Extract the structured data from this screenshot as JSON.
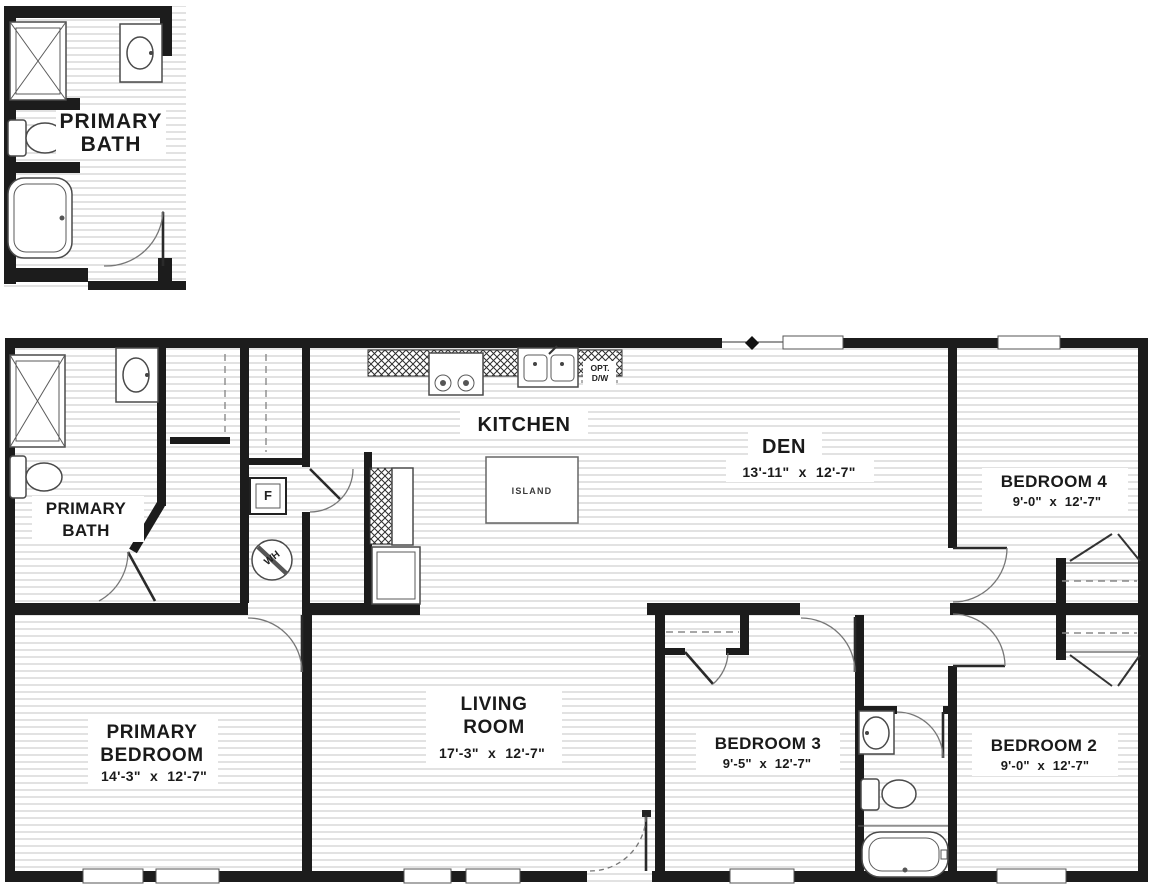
{
  "inset": {
    "title_line1": "PRIMARY",
    "title_line2": "BATH"
  },
  "rooms": {
    "primary_bath": {
      "line1": "PRIMARY",
      "line2": "BATH"
    },
    "kitchen": {
      "name": "KITCHEN"
    },
    "den": {
      "name": "DEN",
      "dims": "13'-11\" x 12'-7\""
    },
    "bedroom4": {
      "name": "BEDROOM 4",
      "dims": "9'-0\" x 12'-7\""
    },
    "primary_bedroom": {
      "line1": "PRIMARY",
      "line2": "BEDROOM",
      "dims": "14'-3\" x 12'-7\""
    },
    "living_room": {
      "line1": "LIVING",
      "line2": "ROOM",
      "dims": "17'-3\" x 12'-7\""
    },
    "bedroom3": {
      "name": "BEDROOM 3",
      "dims": "9'-5\" x 12'-7\""
    },
    "bedroom2": {
      "name": "BEDROOM 2",
      "dims": "9'-0\" x 12'-7\""
    }
  },
  "fixtures": {
    "island": "ISLAND",
    "furnace": "F",
    "water_heater": "WH",
    "opt_dw_line1": "OPT.",
    "opt_dw_line2": "D/W"
  },
  "colors": {
    "wall": "#1c1c1c",
    "floor_stripe": "#c4c4c4",
    "text": "#1a1a1a"
  }
}
